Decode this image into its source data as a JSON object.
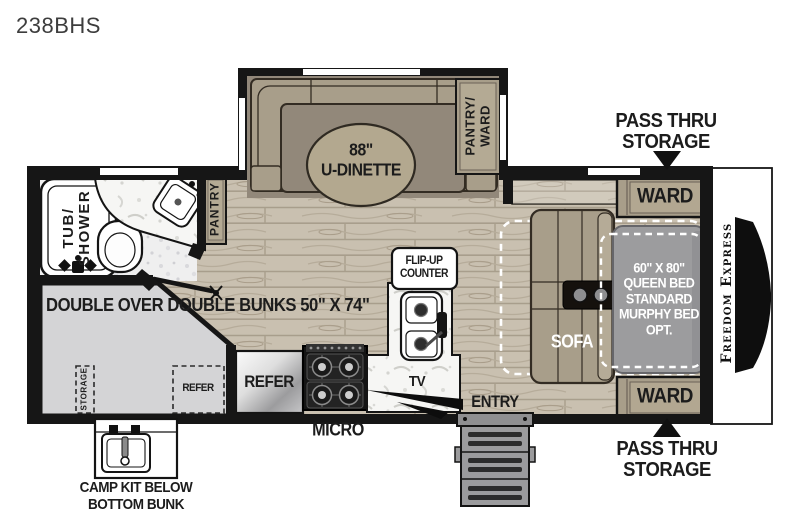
{
  "title": "238BHS",
  "colors": {
    "wall": "#161616",
    "furniture_tan": "#a89e8a",
    "wood_floor": "#c9c0b0",
    "bunk_gray": "#d4d4d6",
    "bed_gray": "#9c9c9e",
    "dashed_outline": "#ffffff"
  },
  "labels": {
    "dinette_size": "88\"",
    "dinette_name": "U-DINETTE",
    "pantry_ward_line1": "PANTRY/",
    "pantry_ward_line2": "WARD",
    "pass_thru_line1": "PASS THRU",
    "pass_thru_line2": "STORAGE",
    "ward_top": "WARD",
    "ward_bottom": "WARD",
    "bed_line1": "60\" X 80\"",
    "bed_line2": "QUEEN BED",
    "bed_line3": "STANDARD",
    "bed_line4": "MURPHY BED",
    "bed_line5": "OPT.",
    "sofa": "SOFA",
    "brand": "Freedom Express",
    "tub_line1": "TUB/",
    "tub_line2": "SHOWER",
    "pantry": "PANTRY",
    "bunks_line1": "DOUBLE OVER",
    "bunks_line2": "DOUBLE BUNKS",
    "bunks_line3": "50\" X 74\"",
    "bunk_storage": "STORAGE",
    "bunk_refer": "REFER",
    "refer": "REFER",
    "micro": "MICRO",
    "tv": "TV",
    "flip_up_line1": "FLIP-UP",
    "flip_up_line2": "COUNTER",
    "entry": "ENTRY",
    "camp_kit_line1": "CAMP KIT BELOW",
    "camp_kit_line2": "BOTTOM BUNK"
  }
}
